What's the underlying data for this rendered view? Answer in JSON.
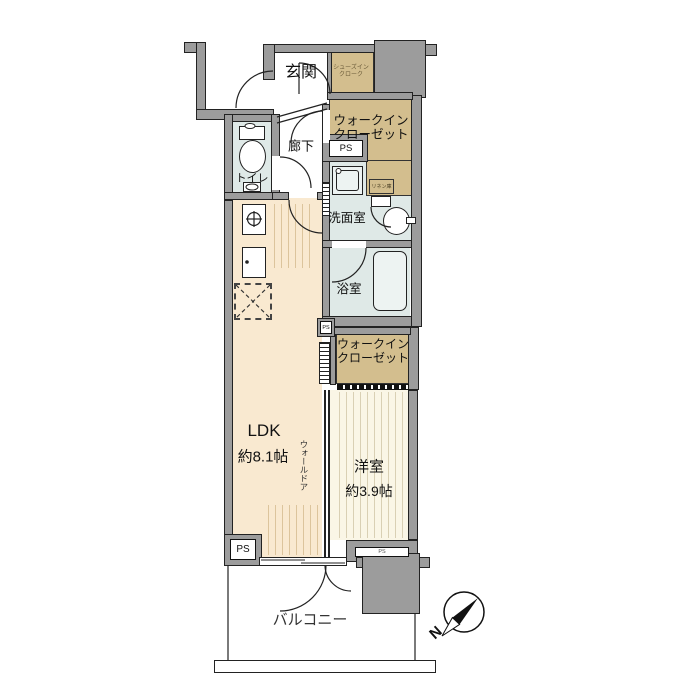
{
  "palette": {
    "wall": "#9c9c9c",
    "ldk_floor": "#f9e9d0",
    "western_floor": "#faf6e6",
    "closet": "#d3be8e",
    "wet": "#dfe9e7",
    "fixture": "#edf3f2",
    "hatch_ldk": "#dcc49c",
    "hatch_western": "#d9d0b4"
  },
  "rooms": {
    "genkan": {
      "label": "玄関"
    },
    "shoes_cloak": {
      "line1": "シューズイン",
      "line2": "クローク"
    },
    "wic_upper": {
      "line1": "ウォークイン",
      "line2": "クローゼット"
    },
    "corridor": {
      "label": "廊下"
    },
    "toilet": {
      "label": "トイレ"
    },
    "washroom": {
      "label": "洗面室"
    },
    "linen": {
      "label": "リネン庫"
    },
    "bath": {
      "label": "浴室"
    },
    "ldk": {
      "label": "LDK",
      "size": "約8.1帖"
    },
    "wall_door": {
      "label": "ウォールドア"
    },
    "wic_lower": {
      "line1": "ウォークイン",
      "line2": "クローゼット"
    },
    "western_room": {
      "label": "洋室",
      "size": "約3.9帖"
    },
    "balcony": {
      "label": "バルコニー"
    }
  },
  "ps": {
    "upper": "PS",
    "middle": "PS",
    "bottom_left": "PS",
    "bottom_right": "PS"
  },
  "compass": {
    "north_label": "N"
  }
}
